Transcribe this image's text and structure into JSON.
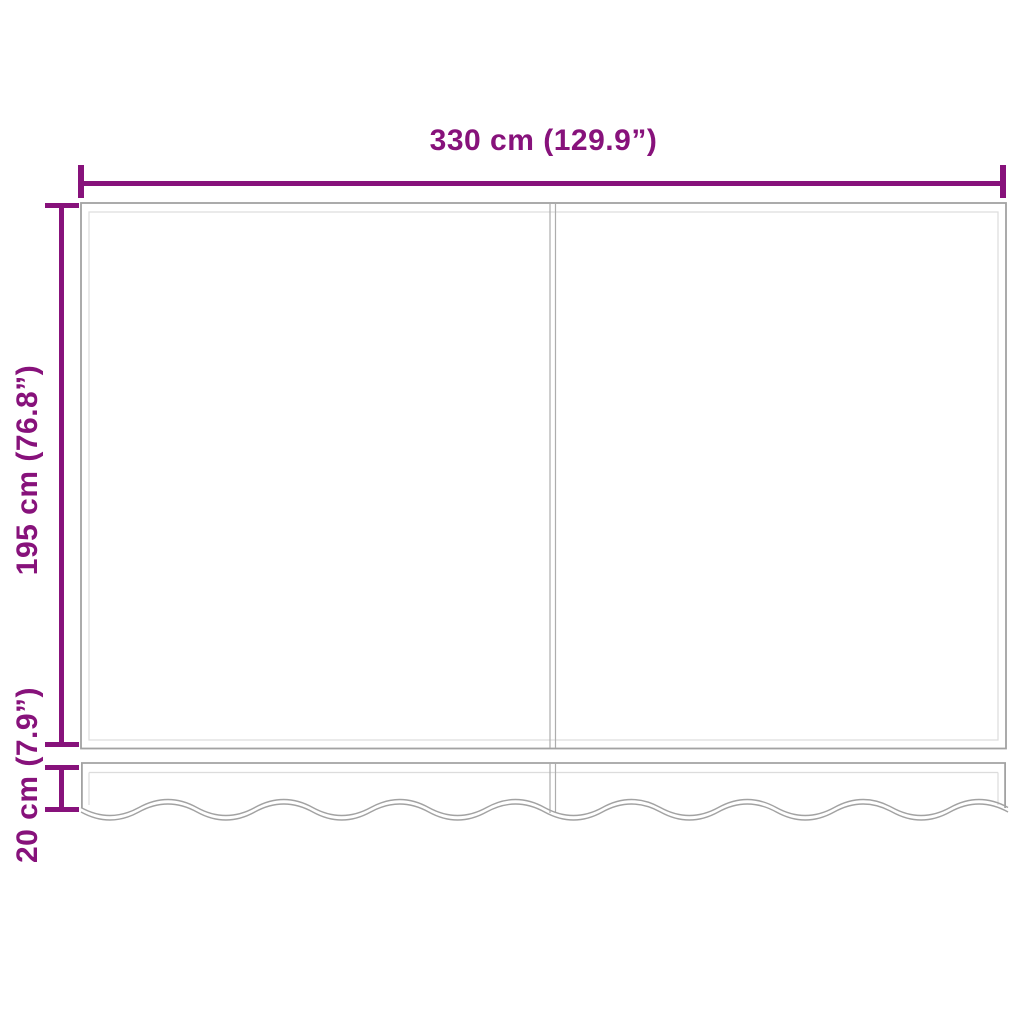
{
  "diagram": {
    "colors": {
      "accent": "#87127B",
      "outline": "#A2A2A2",
      "outline_light": "#DCDCDC",
      "background": "#FFFFFF"
    },
    "dimensions": {
      "width": {
        "label": "330 cm (129.9”)",
        "value_cm": "330 cm",
        "value_in": "129.9”"
      },
      "height": {
        "label": "195 cm (76.8”)",
        "value_cm": "195 cm",
        "value_in": "76.8”"
      },
      "valance_height": {
        "label": "20 cm (7.9”)",
        "value_cm": "20 cm",
        "value_in": "7.9”"
      }
    }
  }
}
